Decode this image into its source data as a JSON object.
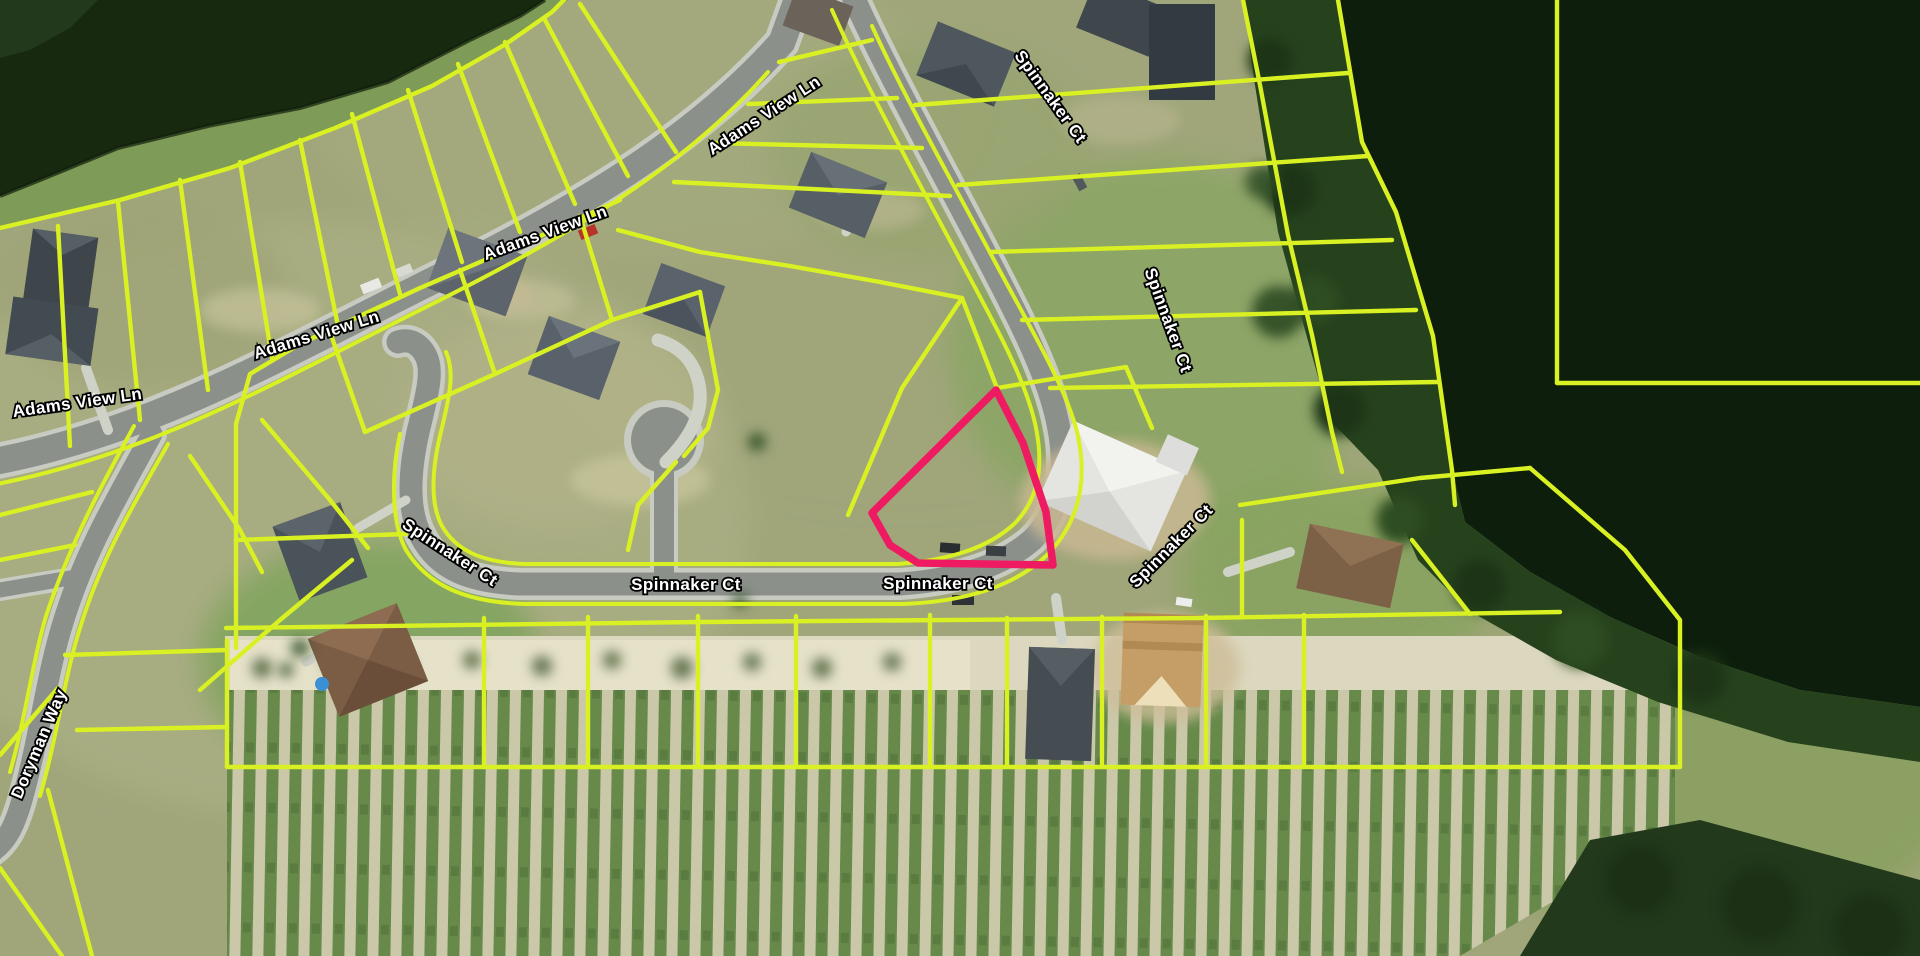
{
  "map": {
    "title": "Aerial parcel map",
    "description": "Satellite imagery with parcel boundary overlay and one highlighted parcel",
    "streets": [
      "Adams View Ln",
      "Spinnaker Ct",
      "Doryman Way"
    ],
    "labels": [
      {
        "id": "adams-view-ln-1",
        "text": "Adams View Ln"
      },
      {
        "id": "adams-view-ln-2",
        "text": "Adams View Ln"
      },
      {
        "id": "adams-view-ln-3",
        "text": "Adams View Ln"
      },
      {
        "id": "adams-view-ln-4",
        "text": "Adams View Ln"
      },
      {
        "id": "spinnaker-ct-top",
        "text": "Spinnaker Ct"
      },
      {
        "id": "spinnaker-ct-right",
        "text": "Spinnaker Ct"
      },
      {
        "id": "spinnaker-ct-elbow",
        "text": "Spinnaker Ct"
      },
      {
        "id": "spinnaker-ct-center",
        "text": "Spinnaker Ct"
      },
      {
        "id": "spinnaker-ct-east",
        "text": "Spinnaker Ct"
      },
      {
        "id": "spinnaker-ct-curve",
        "text": "Spinnaker Ct"
      },
      {
        "id": "doryman-way",
        "text": "Doryman Way"
      }
    ],
    "colors": {
      "parcel_line": "#d9f122",
      "highlighted_parcel": "#ee1b63",
      "water": "#0d1f0c",
      "road": "#8b908b",
      "label_text": "#ffffff",
      "label_outline": "#000000"
    },
    "highlighted_parcel": {
      "name": "selected-parcel",
      "stroke_color": "#ee1b63"
    }
  }
}
